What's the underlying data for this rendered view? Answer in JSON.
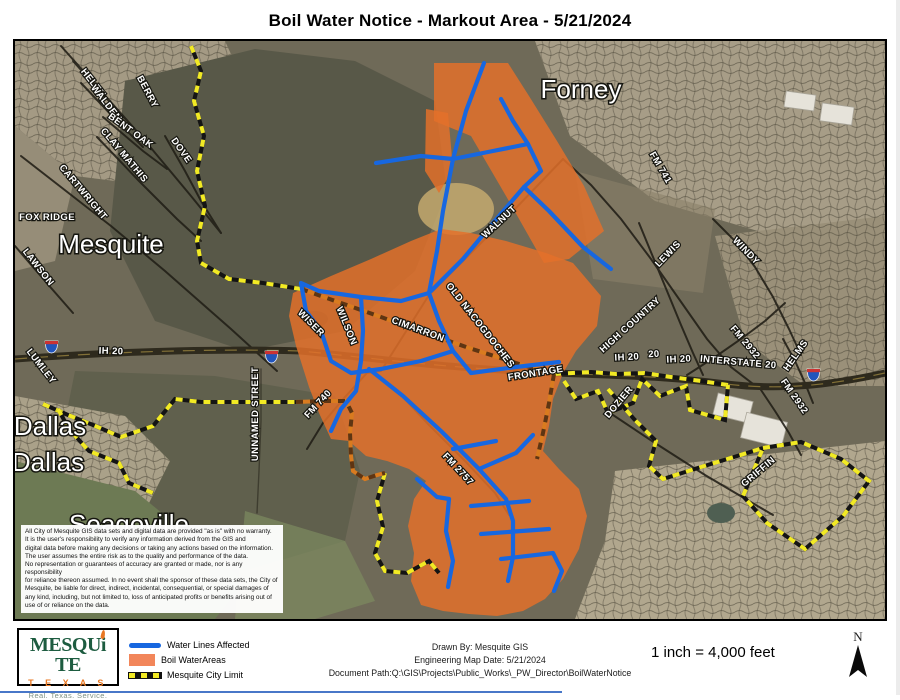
{
  "title": "Boil Water Notice - Markout Area - 5/21/2024",
  "map": {
    "labels": [
      {
        "t": "Mesquite",
        "x": 96,
        "y": 212,
        "r": 0,
        "k": "city",
        "s": 27
      },
      {
        "t": "Forney",
        "x": 566,
        "y": 57,
        "r": 0,
        "k": "city",
        "s": 27
      },
      {
        "t": "Dallas",
        "x": 35,
        "y": 394,
        "r": 0,
        "k": "city",
        "s": 26
      },
      {
        "t": "Dallas",
        "x": 33,
        "y": 430,
        "r": 0,
        "k": "city",
        "s": 26
      },
      {
        "t": "Seagoville",
        "x": 114,
        "y": 492,
        "r": 0,
        "k": "city",
        "s": 26
      },
      {
        "t": "FOX RIDGE",
        "x": 32,
        "y": 179,
        "r": 0,
        "s": 11
      },
      {
        "t": "HELEN",
        "x": 76,
        "y": 44,
        "r": 52
      },
      {
        "t": "WALDEN",
        "x": 89,
        "y": 64,
        "r": 52
      },
      {
        "t": "BERRY",
        "x": 130,
        "y": 52,
        "r": 62
      },
      {
        "t": "BENT OAK",
        "x": 114,
        "y": 92,
        "r": 36
      },
      {
        "t": "CLAY MATHIS",
        "x": 107,
        "y": 116,
        "r": 50
      },
      {
        "t": "DOVE",
        "x": 164,
        "y": 111,
        "r": 55
      },
      {
        "t": "CARTWRIGHT",
        "x": 66,
        "y": 153,
        "r": 50
      },
      {
        "t": "LAWSON",
        "x": 21,
        "y": 228,
        "r": 52
      },
      {
        "t": "LUMLEY",
        "x": 24,
        "y": 327,
        "r": 52
      },
      {
        "t": "UNNAMED STREET",
        "x": 243,
        "y": 373,
        "r": -90
      },
      {
        "t": "IH 20",
        "x": 96,
        "y": 313,
        "r": 2
      },
      {
        "t": "WISER",
        "x": 294,
        "y": 284,
        "r": 45
      },
      {
        "t": "WILSON",
        "x": 329,
        "y": 286,
        "r": 68
      },
      {
        "t": "CIMARRON",
        "x": 402,
        "y": 291,
        "r": 20
      },
      {
        "t": "OLD NACOGDOCHES",
        "x": 463,
        "y": 286,
        "r": 52
      },
      {
        "t": "WALNUT",
        "x": 486,
        "y": 183,
        "r": -43
      },
      {
        "t": "FRONTAGE",
        "x": 521,
        "y": 335,
        "r": -9
      },
      {
        "t": "FM 740",
        "x": 305,
        "y": 365,
        "r": -47
      },
      {
        "t": "FM 741",
        "x": 643,
        "y": 128,
        "r": 60
      },
      {
        "t": "LEWIS",
        "x": 655,
        "y": 215,
        "r": -46
      },
      {
        "t": "WINDY",
        "x": 729,
        "y": 212,
        "r": 46
      },
      {
        "t": "HIGH COUNTRY",
        "x": 617,
        "y": 286,
        "r": -42
      },
      {
        "t": "FM 2932",
        "x": 728,
        "y": 303,
        "r": 50
      },
      {
        "t": "HELMS",
        "x": 783,
        "y": 316,
        "r": -55
      },
      {
        "t": "IH 20",
        "x": 612,
        "y": 319,
        "r": -3
      },
      {
        "t": "20",
        "x": 639,
        "y": 316,
        "r": -3
      },
      {
        "t": "IH 20",
        "x": 664,
        "y": 321,
        "r": -3
      },
      {
        "t": "INTERSTATE 20",
        "x": 723,
        "y": 324,
        "r": 5
      },
      {
        "t": "FM 2932",
        "x": 777,
        "y": 357,
        "r": 55
      },
      {
        "t": "DOZIER",
        "x": 606,
        "y": 363,
        "r": -50
      },
      {
        "t": "FM 2757",
        "x": 441,
        "y": 430,
        "r": 47
      },
      {
        "t": "GRIFFIN",
        "x": 745,
        "y": 433,
        "r": -40
      }
    ],
    "disclaimer_lines": [
      "All City of Mesquite GIS data sets and digital data are provided \"as is\" with no warranty.",
      "It is the user's responsibility to verify any information derived from the GIS and",
      "digital data before making any decisions or taking any actions based on the information.",
      "The user assumes the entire risk as to the quality and performance of the data.",
      "No representation or guarantees of accuracy are granted or made, nor is any responsibility",
      "for reliance thereon assumed. In no event shall the sponsor of these data sets, the City of",
      "Mesquite, be liable for direct, indirect, incidental, consequential, or special damages of",
      "any kind, including, but not limited to, loss of anticipated profits or benefits arising out of",
      "use of or reliance on the data."
    ]
  },
  "legend": {
    "logo": {
      "p1": "MESQU",
      "i": "i",
      "p2": "TE",
      "state": "T E X A S",
      "tagline": "Real. Texas. Service."
    },
    "items": [
      {
        "label": "Water Lines Affected"
      },
      {
        "label": "Boil WaterAreas"
      },
      {
        "label": "Mesquite City Limit"
      }
    ]
  },
  "footer": {
    "drawn_by": "Drawn By: Mesquite GIS",
    "map_date": "Engineering Map Date:  5/21/2024",
    "doc_path": "Document Path:Q:\\GIS\\Projects\\Public_Works\\_PW_Director\\BoilWaterNotice",
    "scale": "1 inch = 4,000 feet",
    "north_label": "N"
  },
  "colors": {
    "water_line": "#1767e0",
    "boil_area": "#e4702a",
    "city_limit_yellow": "#f2ea24",
    "logo_green": "#1d5c40",
    "logo_orange": "#e87722"
  }
}
